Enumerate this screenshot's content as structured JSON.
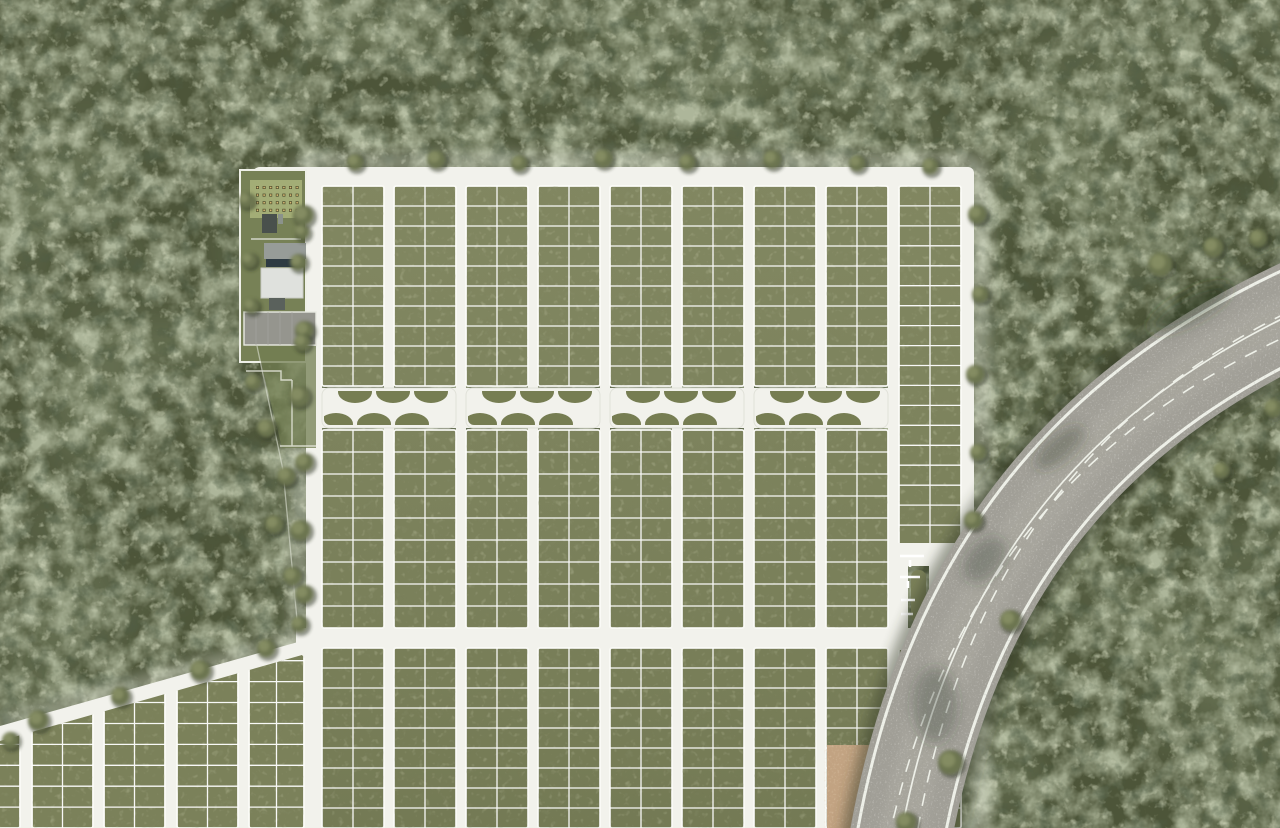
{
  "scene": {
    "label": "Aerial master-plan render of a forested land subdivision with lot grid, amenity area, linear park and curved access highway",
    "width": 1280,
    "height": 828
  },
  "colors": {
    "forest_base": "#4d5539",
    "forest_mid": "#6c7550",
    "forest_light": "#8e9569",
    "forest_shadow": "#2c3320",
    "grass_block": "#7b815a",
    "lawn": "#a3ad76",
    "meadow": "#717e52",
    "park_green": "#767d52",
    "road_white": "#f2f2ec",
    "lot_line": "#ffffff",
    "asphalt": "#a19f97",
    "road_line": "#eef0e8",
    "dirt": "#c2a382",
    "pool": "#2e3b43",
    "roof_white": "#dfe1dd",
    "roof_gray": "#979c98",
    "roof_dark": "#49504c",
    "parking": "#95958e",
    "picnic_table": "#4f4c2e",
    "picnic_top": "#d6ba74"
  },
  "layout": {
    "grid": {
      "colX": [
        322,
        394,
        466,
        538,
        610,
        682,
        754,
        826,
        899
      ],
      "blockW": 62,
      "band1": {
        "y": 186,
        "h": 200,
        "rows": 10
      },
      "band2": {
        "y": 430,
        "h": 198,
        "rows": 9
      },
      "band3": {
        "y": 648,
        "h": 180,
        "rows": 9
      },
      "col9": {
        "y": 186,
        "h": 359,
        "rows": 18
      },
      "park": {
        "y": 388,
        "h": 40,
        "segs": [
          [
            322,
            456
          ],
          [
            466,
            600
          ],
          [
            610,
            744
          ],
          [
            754,
            888
          ]
        ]
      },
      "roads": {
        "top": {
          "x": 252,
          "y": 167,
          "w": 722,
          "h": 19
        },
        "left": {
          "x": 306,
          "y": 167,
          "w": 16,
          "h": 661
        },
        "right": {
          "x": 952,
          "y": 167,
          "w": 22,
          "h": 392
        },
        "bottom": {
          "x": 296,
          "y": 628,
          "w": 646,
          "h": 20
        },
        "vRoadTop": 186,
        "vRoadH": 642
      }
    },
    "sw": {
      "colX": [
        -40,
        32,
        104,
        177,
        249
      ],
      "widths": [
        60,
        61,
        61,
        61,
        55
      ],
      "blockTop": 598,
      "blockH": 230,
      "rows": 11,
      "white": "0,726 298,642 306,640 306,828 0,828",
      "clip": "0,741 302,655 306,660 306,828 0,828"
    },
    "picnic": {
      "x": 256,
      "y": 186,
      "cols": 7,
      "rows": 4,
      "dx": 6.6,
      "dy": 7.6
    },
    "trees": [
      [
        303,
        215,
        10
      ],
      [
        298,
        262,
        8
      ],
      [
        304,
        330,
        9
      ],
      [
        299,
        396,
        10
      ],
      [
        304,
        462,
        9
      ],
      [
        300,
        530,
        10
      ],
      [
        304,
        594,
        9
      ],
      [
        299,
        624,
        8
      ],
      [
        355,
        162,
        8
      ],
      [
        436,
        159,
        9
      ],
      [
        519,
        163,
        8
      ],
      [
        603,
        158,
        9
      ],
      [
        687,
        162,
        8
      ],
      [
        772,
        159,
        9
      ],
      [
        857,
        163,
        8
      ],
      [
        930,
        166,
        8
      ],
      [
        977,
        214,
        9
      ],
      [
        980,
        294,
        8
      ],
      [
        975,
        374,
        9
      ],
      [
        978,
        452,
        8
      ],
      [
        973,
        520,
        9
      ],
      [
        38,
        720,
        10
      ],
      [
        120,
        696,
        9
      ],
      [
        200,
        670,
        10
      ],
      [
        266,
        648,
        9
      ],
      [
        10,
        740,
        8
      ],
      [
        246,
        200,
        7
      ],
      [
        302,
        232,
        7
      ],
      [
        249,
        260,
        7
      ],
      [
        251,
        306,
        7
      ],
      [
        302,
        342,
        8
      ],
      [
        253,
        382,
        8
      ],
      [
        266,
        428,
        9
      ],
      [
        286,
        476,
        9
      ],
      [
        274,
        524,
        9
      ],
      [
        292,
        576,
        9
      ],
      [
        1160,
        264,
        12
      ],
      [
        1213,
        247,
        10
      ],
      [
        1258,
        238,
        9
      ],
      [
        1273,
        408,
        9
      ],
      [
        1221,
        470,
        8
      ],
      [
        1010,
        620,
        10
      ],
      [
        950,
        762,
        12
      ],
      [
        906,
        822,
        10
      ]
    ]
  }
}
